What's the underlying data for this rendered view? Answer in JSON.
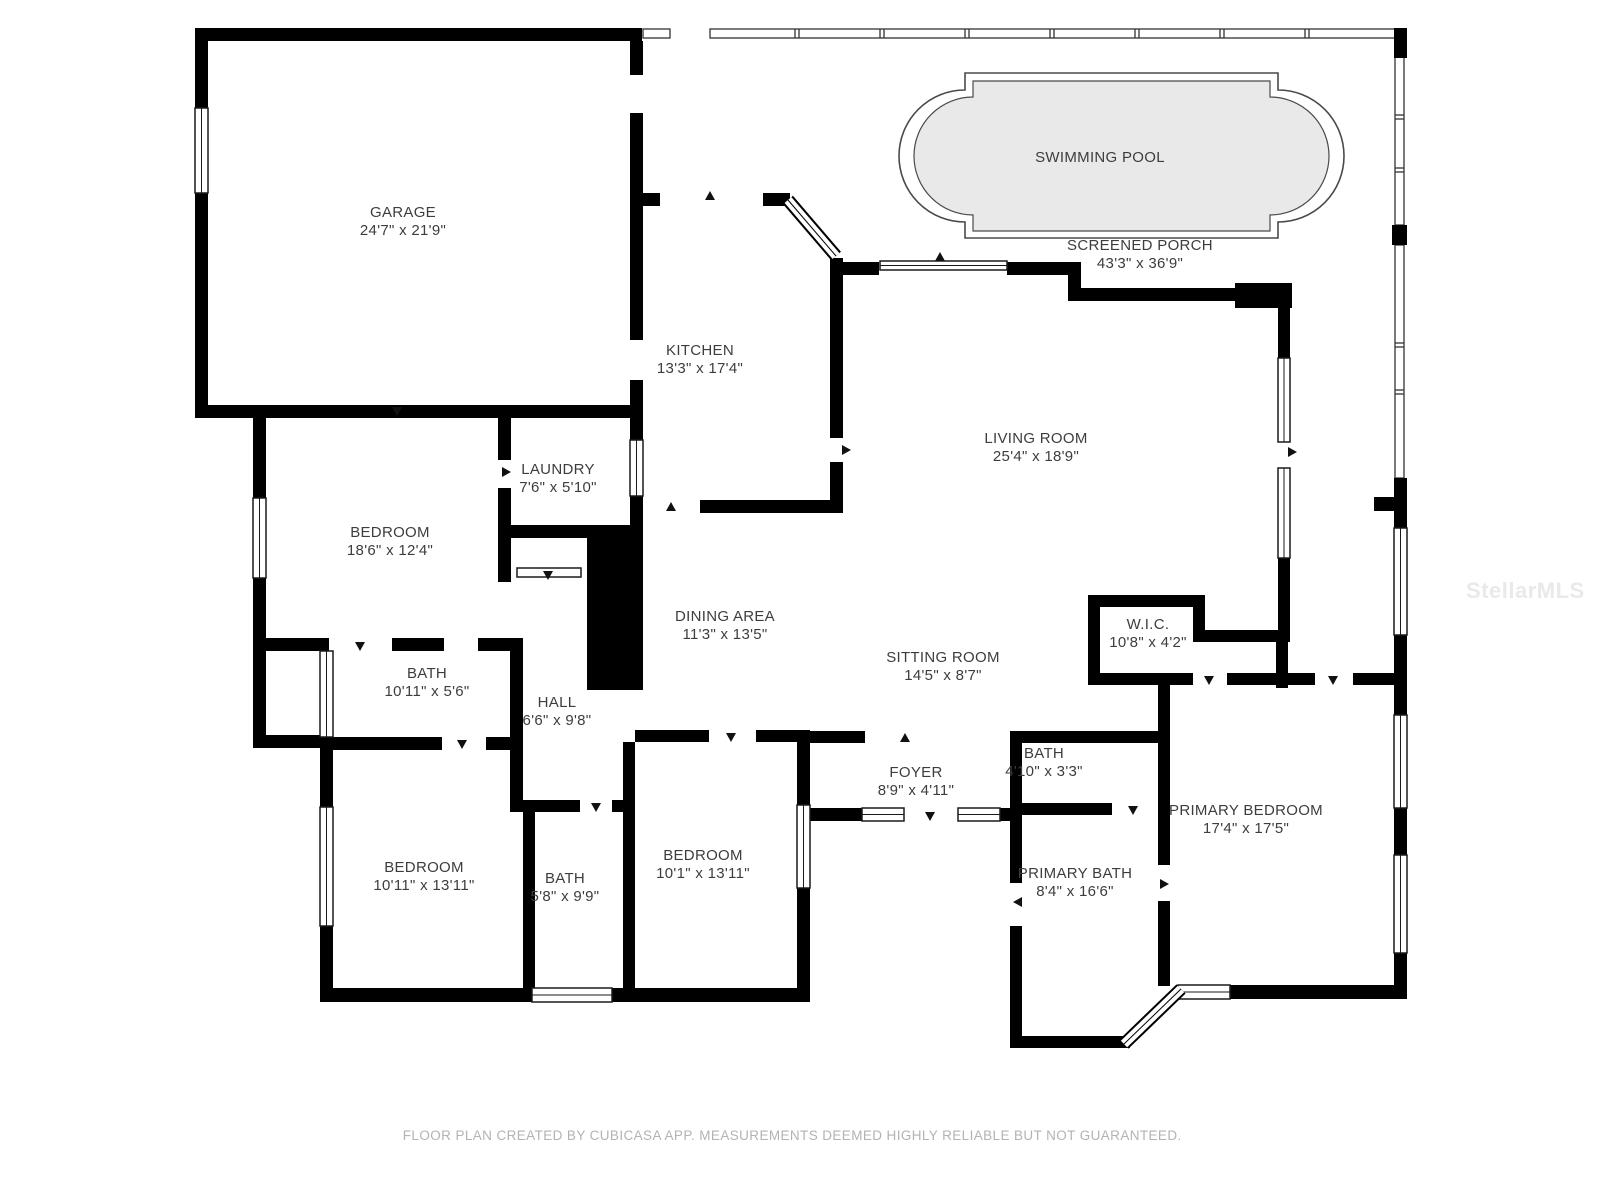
{
  "rooms": [
    {
      "id": "garage",
      "name": "GARAGE",
      "dims": "24'7\" x 21'9\""
    },
    {
      "id": "swimming-pool",
      "name": "SWIMMING POOL",
      "dims": ""
    },
    {
      "id": "screened-porch",
      "name": "SCREENED PORCH",
      "dims": "43'3\" x 36'9\""
    },
    {
      "id": "kitchen",
      "name": "KITCHEN",
      "dims": "13'3\" x 17'4\""
    },
    {
      "id": "living-room",
      "name": "LIVING ROOM",
      "dims": "25'4\" x 18'9\""
    },
    {
      "id": "laundry",
      "name": "LAUNDRY",
      "dims": "7'6\" x 5'10\""
    },
    {
      "id": "bedroom-left",
      "name": "BEDROOM",
      "dims": "18'6\" x 12'4\""
    },
    {
      "id": "dining-area",
      "name": "DINING AREA",
      "dims": "11'3\" x 13'5\""
    },
    {
      "id": "wic",
      "name": "W.I.C.",
      "dims": "10'8\" x 4'2\""
    },
    {
      "id": "sitting-room",
      "name": "SITTING ROOM",
      "dims": "14'5\" x 8'7\""
    },
    {
      "id": "bath-hall",
      "name": "BATH",
      "dims": "10'11\" x 5'6\""
    },
    {
      "id": "hall",
      "name": "HALL",
      "dims": "6'6\" x 9'8\""
    },
    {
      "id": "bath-small",
      "name": "BATH",
      "dims": "4'10\" x 3'3\""
    },
    {
      "id": "foyer",
      "name": "FOYER",
      "dims": "8'9\" x 4'11\""
    },
    {
      "id": "primary-bedroom",
      "name": "PRIMARY BEDROOM",
      "dims": "17'4\" x 17'5\""
    },
    {
      "id": "bedroom-bottom-left",
      "name": "BEDROOM",
      "dims": "10'11\" x 13'11\""
    },
    {
      "id": "bath-center",
      "name": "BATH",
      "dims": "5'8\" x 9'9\""
    },
    {
      "id": "bedroom-bottom-center",
      "name": "BEDROOM",
      "dims": "10'1\" x 13'11\""
    },
    {
      "id": "primary-bath",
      "name": "PRIMARY BATH",
      "dims": "8'4\" x 16'6\""
    }
  ],
  "footer": {
    "disclaimer": "FLOOR PLAN CREATED BY CUBICASA APP. MEASUREMENTS DEEMED HIGHLY RELIABLE BUT NOT GUARANTEED."
  },
  "watermark": {
    "text": "StellarMLS"
  },
  "colors": {
    "wall": "#000000",
    "pool_fill": "#e9e9e9",
    "pool_stroke": "#4a4a4a",
    "label": "#3d3d3d",
    "footer_text": "#b3b3b3",
    "watermark_text": "#e9e9e9"
  }
}
